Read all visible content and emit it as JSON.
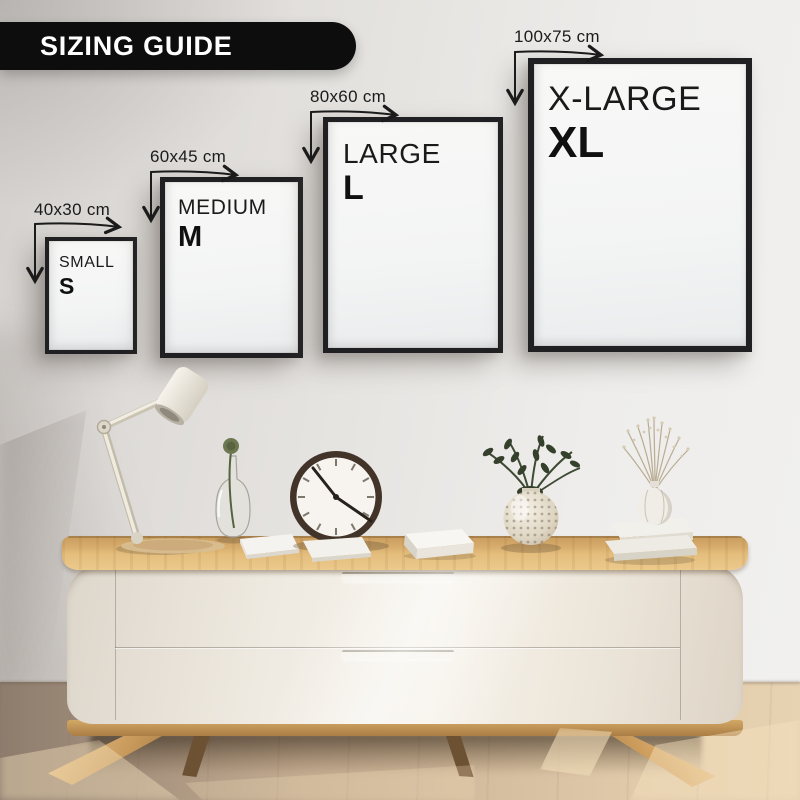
{
  "banner": {
    "label": "SIZING GUIDE"
  },
  "sizes": [
    {
      "name": "SMALL",
      "letter": "S",
      "dimension": "40x30 cm"
    },
    {
      "name": "MEDIUM",
      "letter": "M",
      "dimension": "60x45 cm"
    },
    {
      "name": "LARGE",
      "letter": "L",
      "dimension": "80x60 cm"
    },
    {
      "name": "X-LARGE",
      "letter": "XL",
      "dimension": "100x75 cm"
    }
  ],
  "scene": {
    "furniture": "wooden-top sideboard with two drawers and splayed wooden legs",
    "decor_items": [
      "desk-lamp",
      "woven-tray",
      "glass-bottle-vase",
      "paper-book",
      "wall-clock",
      "white-box",
      "bubble-glass-vase",
      "green-sprigs",
      "book-stack",
      "dried-flower-vase"
    ]
  },
  "colors": {
    "banner-bg": "#0d0d0e",
    "banner-text": "#ffffff",
    "ink": "#1b1b1c",
    "frame-border": "#202022",
    "frame-fill": "#f7f7f6",
    "wall-light": "#f1f0ef",
    "wall-dark": "#d5d2cf",
    "wood-light": "#eac98b",
    "wood-mid": "#d3a765",
    "wood-dark": "#a97c45",
    "cabinet-light": "#f6f2ea",
    "cabinet-dark": "#ddd4c6",
    "floor-light": "#e7d2b2",
    "floor-dark": "#8d7c6d",
    "plant-green": "#3a462f",
    "clock-rim": "#43342a"
  }
}
